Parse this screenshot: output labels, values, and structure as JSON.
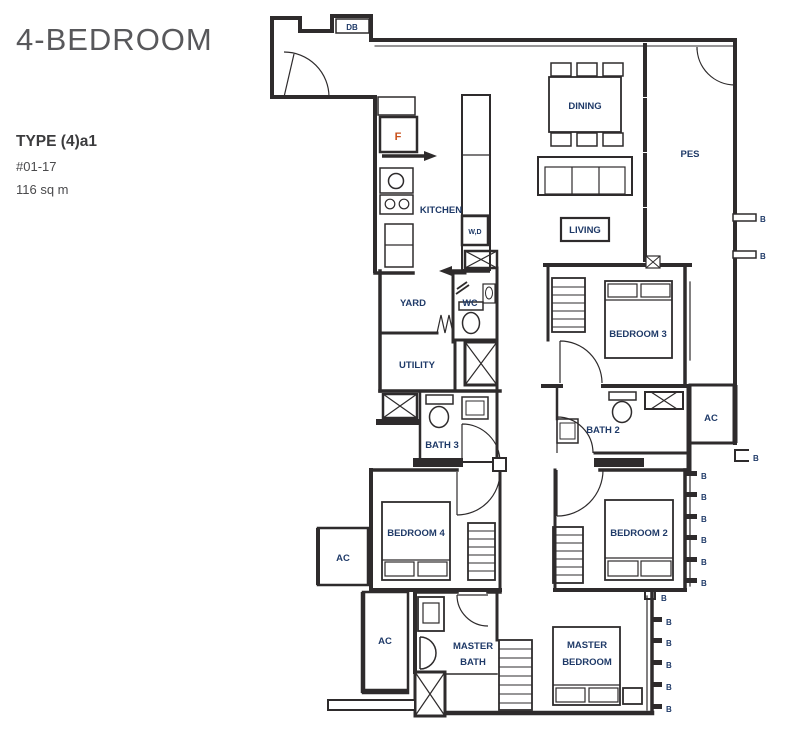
{
  "header": {
    "title": "4-BEDROOM",
    "type_label": "TYPE (4)a1",
    "unit_number": "#01-17",
    "floor_area": "116 sq m"
  },
  "plan_labels": {
    "db": "DB",
    "fridge": "F",
    "kitchen": "KITCHEN",
    "washer_dryer": "W,D",
    "dining": "DINING",
    "pes": "PES",
    "living": "LIVING",
    "yard": "YARD",
    "wc": "WC",
    "utility": "UTILITY",
    "bedroom3": "BEDROOM 3",
    "bath3": "BATH 3",
    "bath2": "BATH 2",
    "bedroom4": "BEDROOM 4",
    "bedroom2": "BEDROOM 2",
    "master_line1": "MASTER",
    "master_bath_line2": "BATH",
    "master_bedroom_line2": "BEDROOM",
    "ac": "AC",
    "balcony_marker": "B"
  },
  "colors": {
    "wall": "#2e2b2c",
    "room_label": "#1f3a68",
    "accent": "#c9501b",
    "title_text": "#58585b"
  }
}
